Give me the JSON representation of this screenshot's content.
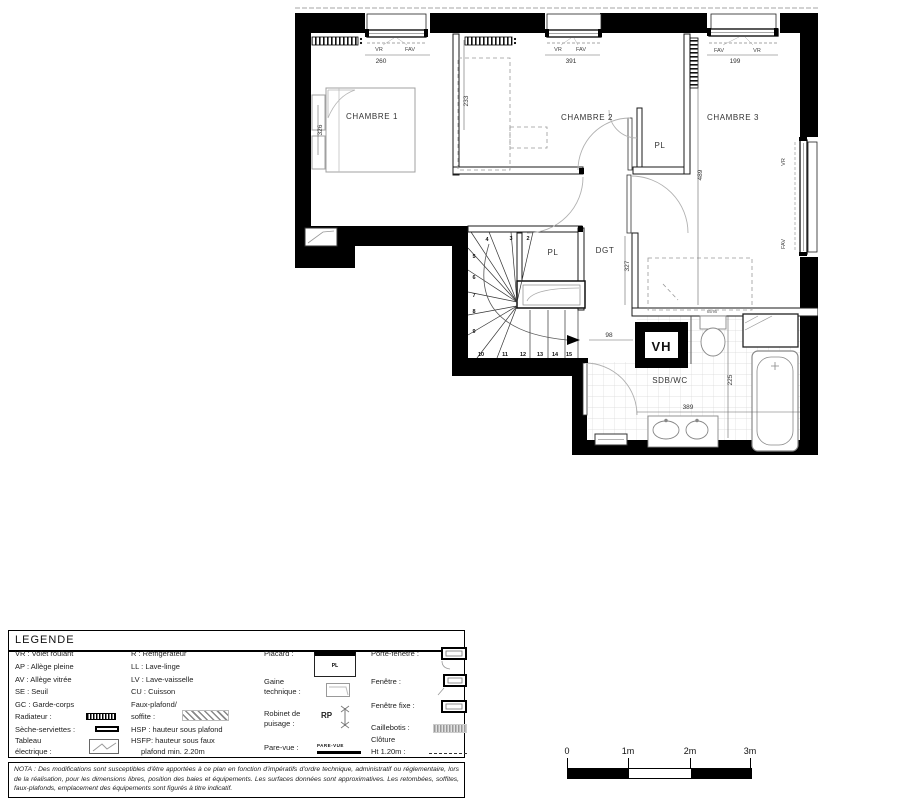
{
  "plan": {
    "room_labels": {
      "chambre1": "CHAMBRE 1",
      "chambre2": "CHAMBRE 2",
      "chambre3": "CHAMBRE 3",
      "pl_top": "PL",
      "pl_stairs": "PL",
      "dgt": "DGT",
      "sdb": "SDB/WC",
      "vh": "VH"
    },
    "window_labels": {
      "w1_vr": "VR",
      "w1_fav": "FAV",
      "w2_vr": "VR",
      "w2_fav": "FAV",
      "w3_fav": "FAV",
      "w3_vr": "VR",
      "right_vr": "VR",
      "right_fav": "FAV"
    },
    "dimensions": {
      "w1": "260",
      "w2": "391",
      "w3": "199",
      "left": "326",
      "c1c2": "233",
      "c3": "489",
      "dgt": "327",
      "stair_vh": "98",
      "sdb_h": "225",
      "sdb_w": "389",
      "fixture": "65/95"
    },
    "stair_steps": [
      "2",
      "3",
      "4",
      "5",
      "6",
      "7",
      "8",
      "9",
      "10",
      "11",
      "12",
      "13",
      "14",
      "15"
    ]
  },
  "legend": {
    "title": "LEGENDE",
    "col1": [
      "VR : Volet roulant",
      "AP : Allège pleine",
      "AV : Allège vitrée",
      "SE : Seuil",
      "GC : Garde-corps",
      "Radiateur :",
      "Sèche-serviettes :",
      "Tableau",
      "électrique :"
    ],
    "col2": [
      "R : Réfrigérateur",
      "LL : Lave-linge",
      "LV : Lave-vaisselle",
      "CU : Cuisson",
      "Faux-plafond/",
      "soffite :",
      "HSP : hauteur sous plafond",
      "HSFP: hauteur sous faux",
      "plafond min. 2.20m"
    ],
    "col3": [
      "Placard :",
      "Gaine",
      "technique :",
      "Robinet de",
      "puisage :",
      "Pare-vue :"
    ],
    "col4": [
      "Porte-fenêtre :",
      "Fenêtre :",
      "Fenêtre fixe :",
      "Caillebotis :",
      "Clôture",
      "Ht 1.20m :"
    ],
    "placard_symbol": "PL",
    "rp_symbol": "RP",
    "parevue_symbol": "PARE-VUE"
  },
  "nota": "NOTA : Des modifications sont susceptibles d'être apportées à ce plan en fonction d'impératifs d'ordre technique, administratif ou réglementaire, lors de la réalisation, pour les dimensions libres, position des baies et équipements. Les surfaces données sont approximatives. Les retombées, soffites, faux-plafonds, emplacement des équipements sont figurés à titre indicatif.",
  "scalebar": {
    "labels": [
      "0",
      "1m",
      "2m",
      "3m"
    ]
  }
}
